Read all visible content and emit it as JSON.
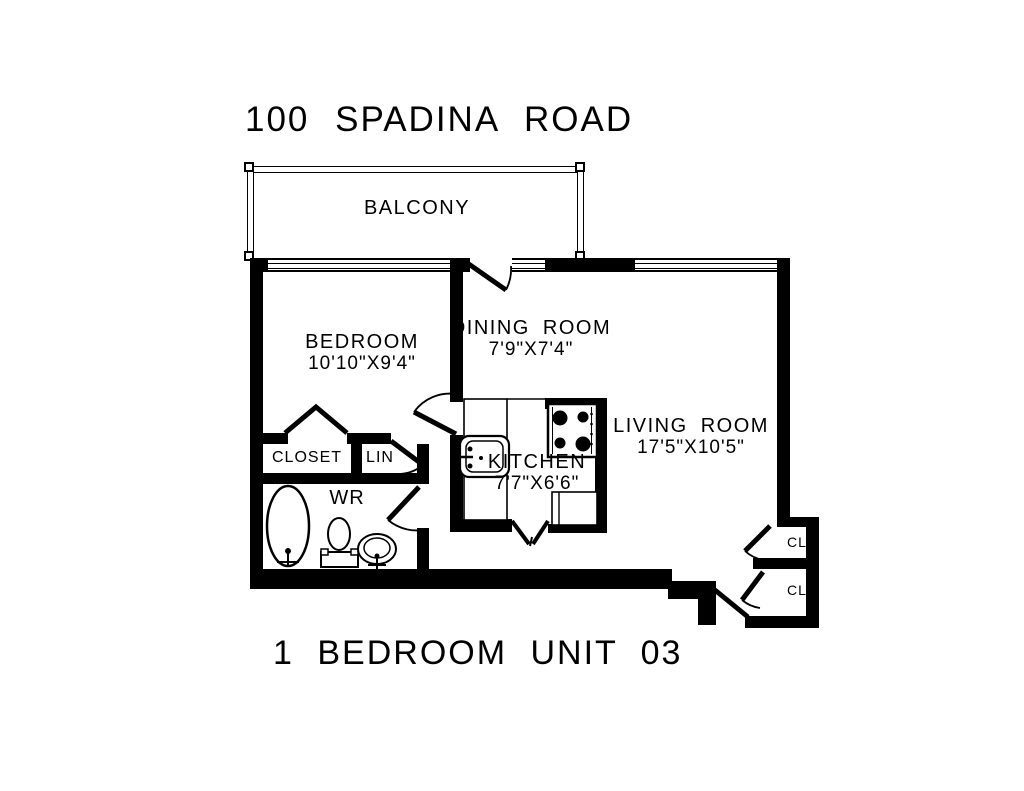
{
  "title": "100 SPADINA ROAD",
  "footer": "1 BEDROOM UNIT 03",
  "rooms": {
    "balcony": {
      "label": "BALCONY"
    },
    "bedroom": {
      "label": "BEDROOM",
      "dims": "10'10\"X9'4\""
    },
    "dining": {
      "label": "DINING ROOM",
      "dims": "7'9\"X7'4\""
    },
    "kitchen": {
      "label": "KITCHEN",
      "dims": "7'7\"X6'6\""
    },
    "living": {
      "label": "LIVING ROOM",
      "dims": "17'5\"X10'5\""
    },
    "closet": {
      "label": "CLOSET"
    },
    "linen": {
      "label": "LIN"
    },
    "washroom": {
      "label": "WR"
    },
    "closet_upper": {
      "label": "CL"
    },
    "closet_lower": {
      "label": "CL"
    }
  },
  "colors": {
    "line": "#000000",
    "background": "#ffffff"
  }
}
